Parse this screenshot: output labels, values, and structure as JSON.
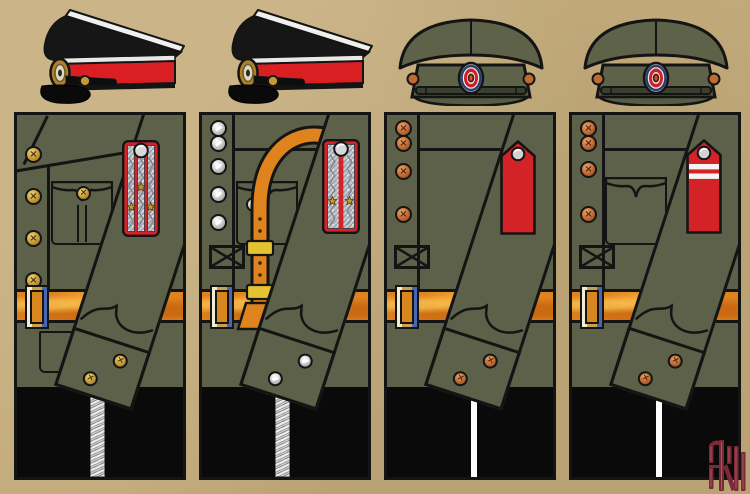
{
  "palette": {
    "background": "#c4ac7d",
    "panel_olive": "#5d6149",
    "cap_black": "#161616",
    "cap_band_red": "#da1f22",
    "piping_white": "#f0f0ee",
    "cap_olive": "#5d6249",
    "belt_orange": "#df831f",
    "board_red": "#d42328",
    "board_silver": "#c3c7cd",
    "trouser_black": "#0a0a0a",
    "stripe_white": "#ffffff",
    "gold_button": "#c49a36",
    "silver_button": "#c6c6c6",
    "copper_button": "#c06a33",
    "star_gold": "#c8992e",
    "monogram_maroon": "#7c2937",
    "outline_black": "#141414"
  },
  "plate": {
    "label": "Uniform comparison plate with four cap-and-tunic columns",
    "common": {
      "belt_label": "orange-tan leather waist belt with frame buckle",
      "trousers_label": "black trousers",
      "sleeve_label": "diagonal right sleeve with two-button cuff"
    },
    "columns": [
      {
        "cap": {
          "label": "black peaked cap, side view: white crown piping, red band, gold oval cockade, black visor and chin strap"
        },
        "tunic": {
          "label": "olive tunic, diagonal lapel front, five gold buttons, buttoned box-pleat chest pocket, lower pocket flap"
        },
        "board": {
          "label": "silver braid shoulder board, red edging, two red stripes, three gold stars, silver button"
        },
        "buttons": "gold",
        "trouser_stripe": "silver braid stripe"
      },
      {
        "cap": {
          "label": "black peaked cap, side view: white crown piping, red band, gold oval cockade, black visor and chin strap"
        },
        "tunic": {
          "label": "olive tunic with yoke seam, five silver buttons, chest pocket, orange leather shoulder strap with brass slides joining the waist belt"
        },
        "board": {
          "label": "silver braid shoulder board, red edging, one central red stripe, two gold stars, silver button"
        },
        "buttons": "silver",
        "trouser_stripe": "silver braid stripe"
      },
      {
        "cap": {
          "label": "olive field cap, front view: domed crown, band with oval red-white-blue cockade, chin strap, visor"
        },
        "tunic": {
          "label": "plain olive tunic with yoke seam and four copper buttons, no chest pocket"
        },
        "board": {
          "label": "plain red pentagon shoulder board with silver button"
        },
        "buttons": "copper",
        "trouser_stripe": "white piping stripe"
      },
      {
        "cap": {
          "label": "olive field cap, front view: domed crown, band with oval red-white-blue cockade, chin strap, visor"
        },
        "tunic": {
          "label": "olive tunic with yoke seam, four copper buttons and plain flapped chest pocket"
        },
        "board": {
          "label": "red pentagon shoulder board with two white rank bands and silver button"
        },
        "buttons": "copper",
        "trouser_stripe": "white piping stripe"
      }
    ]
  },
  "monogram": {
    "label": "artist monogram, maroon on black",
    "color": "#7c2937"
  }
}
